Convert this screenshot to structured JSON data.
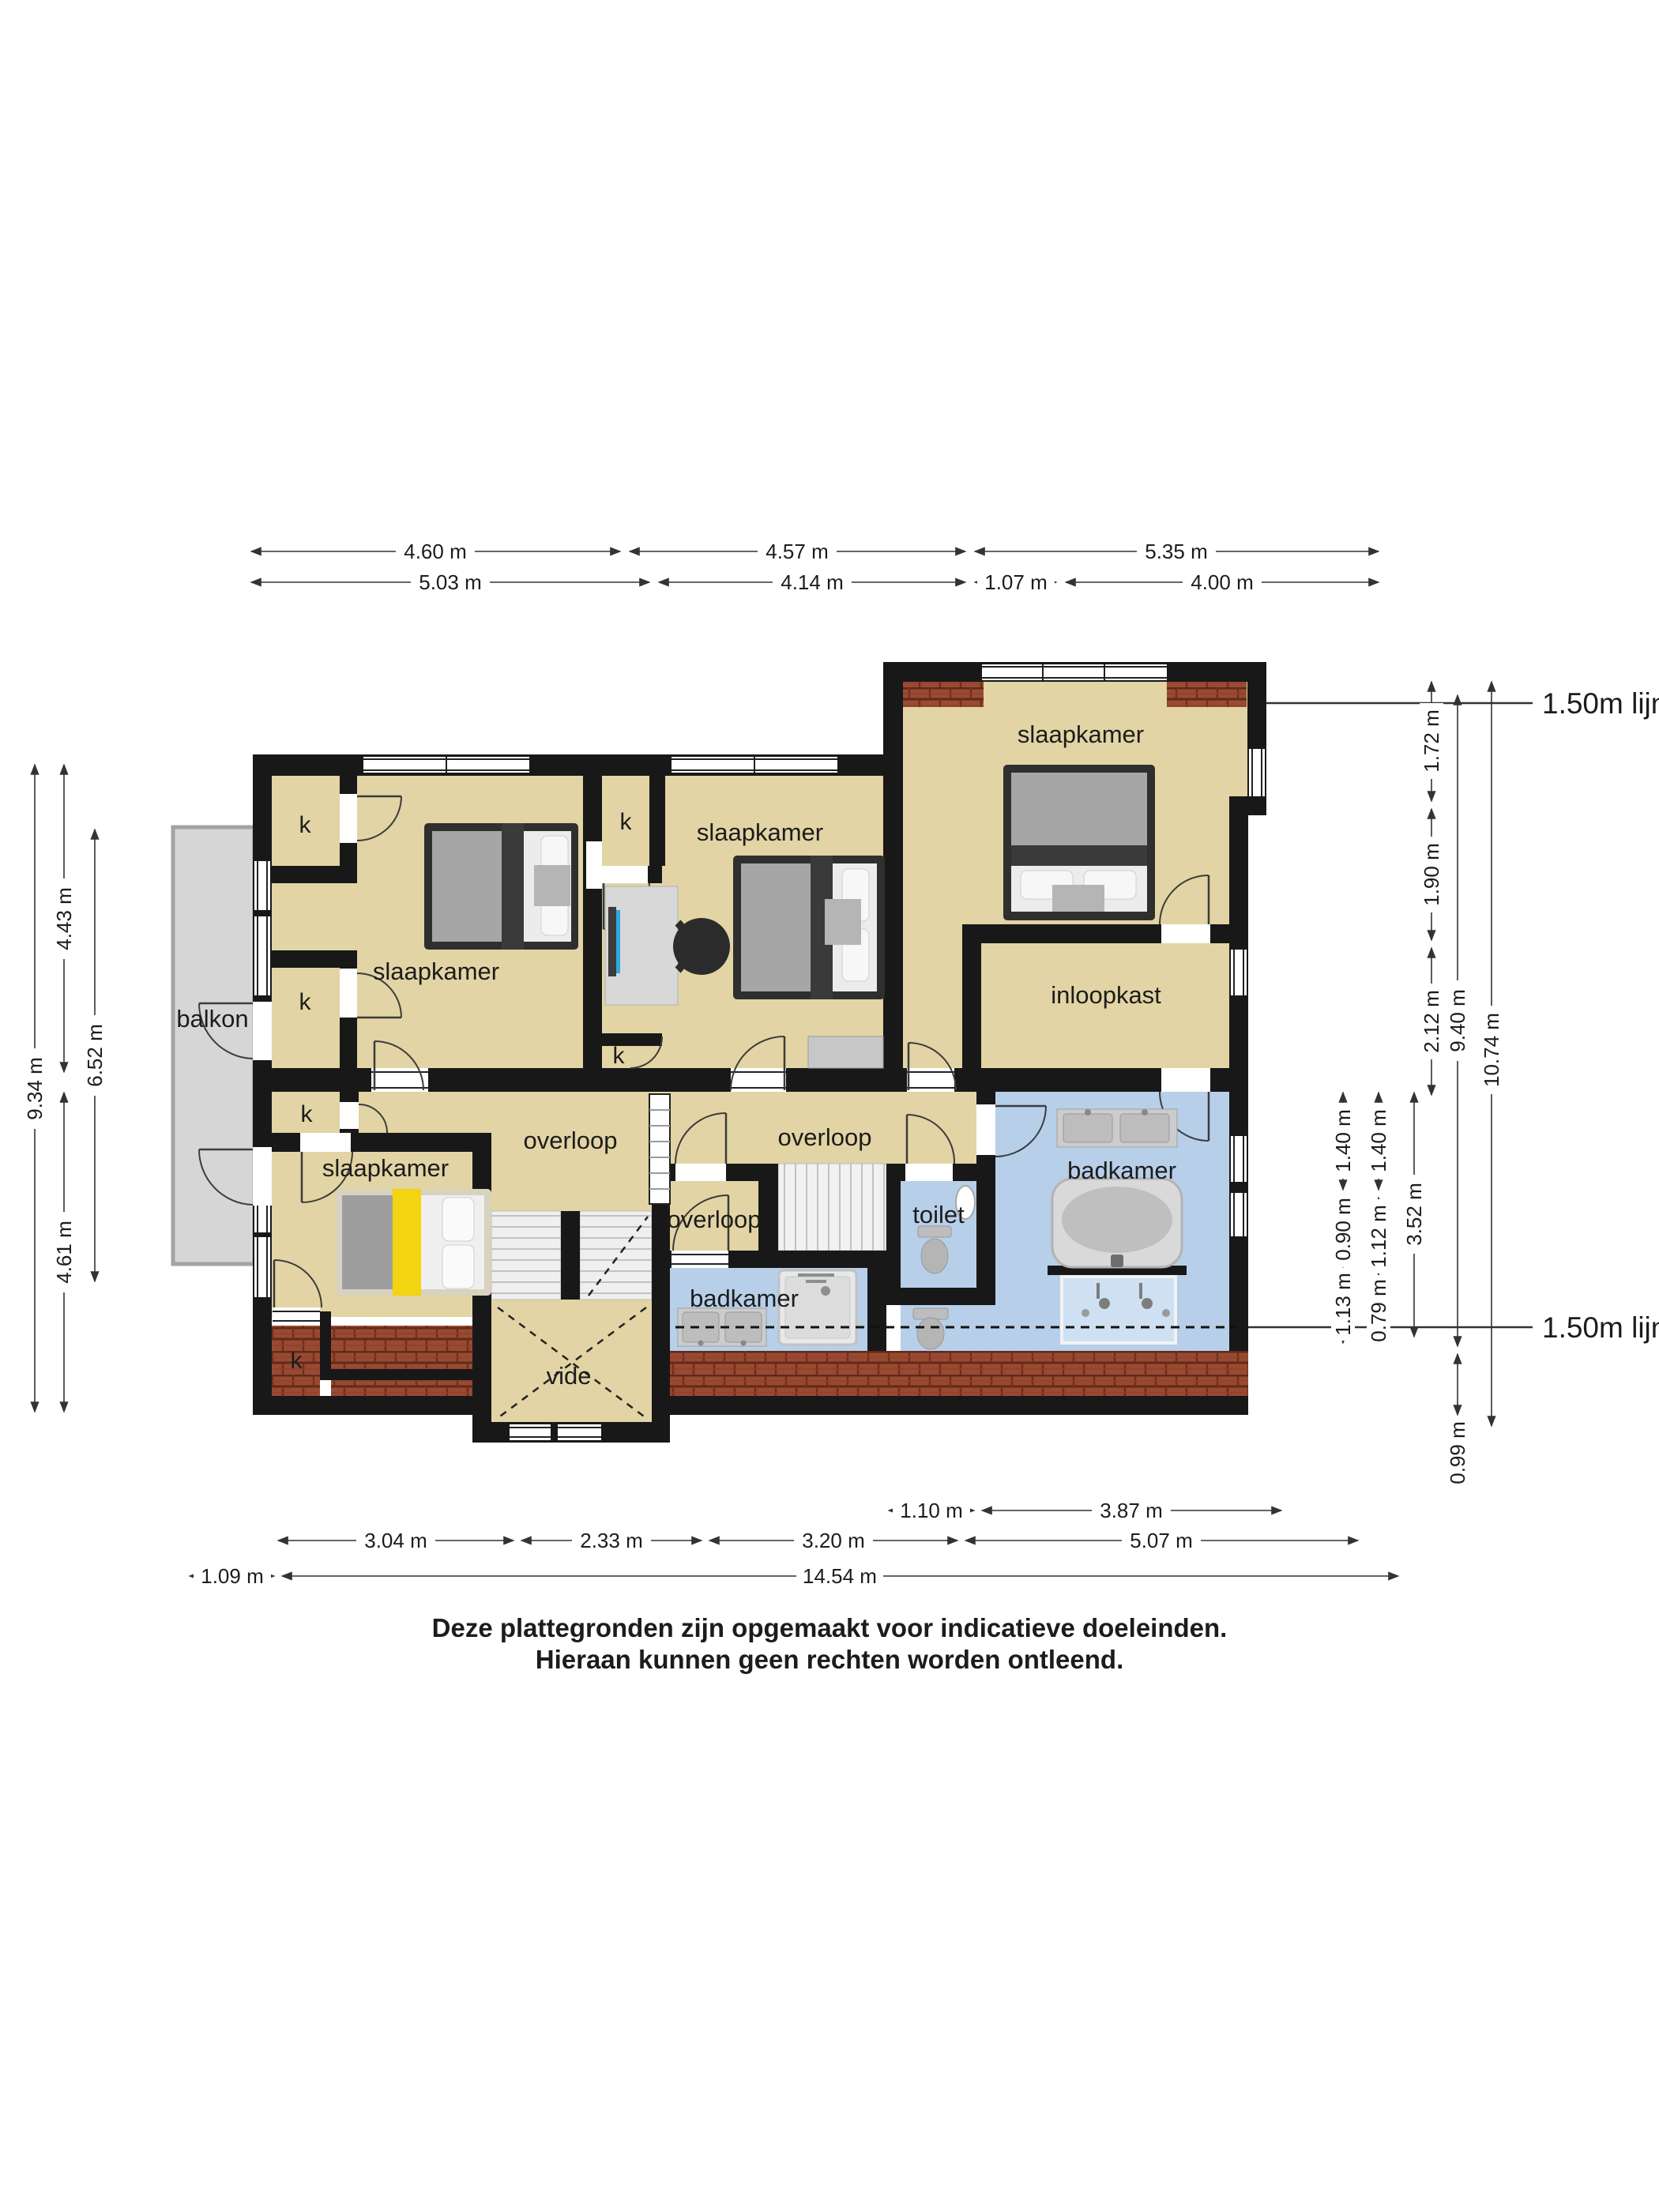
{
  "rooms": {
    "slaapkamer": "slaapkamer",
    "overloop": "overloop",
    "inloopkast": "inloopkast",
    "badkamer": "badkamer",
    "toilet": "toilet",
    "vide": "vide",
    "balkon": "balkon",
    "closet": "k"
  },
  "annotations": {
    "line_150_top": "1.50m lijn",
    "line_150_bottom": "1.50m lijn"
  },
  "dims": {
    "top1": [
      "4.60 m",
      "4.57 m",
      "5.35 m"
    ],
    "top2": [
      "5.03 m",
      "4.14 m",
      "1.07 m",
      "4.00 m"
    ],
    "bottom1": [
      "1.10 m",
      "3.87 m"
    ],
    "bottom2": [
      "3.04 m",
      "2.33 m",
      "3.20 m",
      "5.07 m"
    ],
    "bottom3": [
      "1.09 m",
      "14.54 m"
    ],
    "left": [
      "9.34 m",
      "4.43 m",
      "4.61 m",
      "6.52 m"
    ],
    "right": [
      "1.40 m",
      "0.90 m",
      "1.13 m",
      "1.40 m",
      "1.12 m",
      "0.79 m",
      "3.52 m",
      "1.72 m",
      "1.90 m",
      "2.12 m",
      "9.40 m",
      "0.99 m",
      "10.74 m"
    ]
  },
  "disclaimer": {
    "line1": "Deze plattegronden zijn opgemaakt voor indicatieve doeleinden.",
    "line2": "Hieraan kunnen geen rechten worden ontleend."
  },
  "colors": {
    "wall": "#181818",
    "floor": "#e2d4a4",
    "bath_floor": "#b7cfe9",
    "balcony": "#d6d6d6",
    "roof_tile": "#9a4a31",
    "bed_accent_yellow": "#f2d411",
    "monitor_blue": "#2fa8dd"
  }
}
